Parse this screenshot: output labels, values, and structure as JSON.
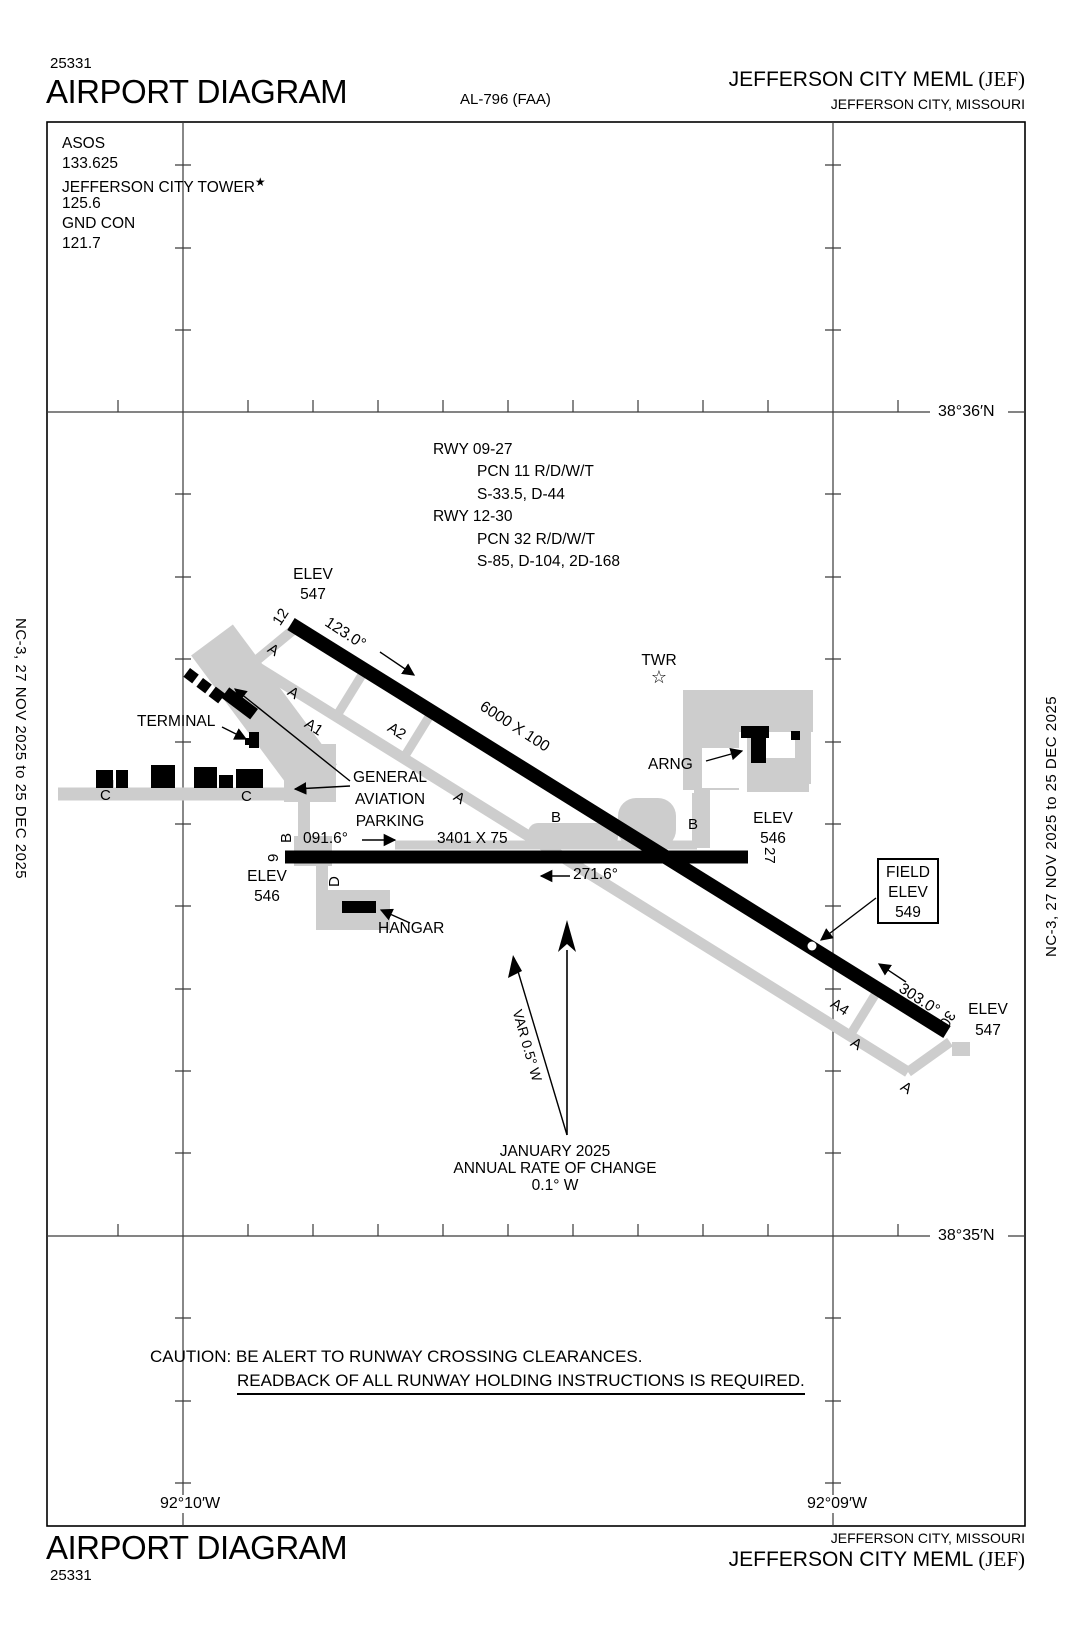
{
  "header": {
    "chart_number": "25331",
    "title": "AIRPORT DIAGRAM",
    "al_ref": "AL-796 (FAA)",
    "airport_name": "JEFFERSON CITY MEML",
    "airport_code": "(JEF)",
    "city": "JEFFERSON CITY, MISSOURI"
  },
  "comm": {
    "asos_label": "ASOS",
    "asos_freq": "133.625",
    "tower_label": "JEFFERSON CITY TOWER",
    "tower_star": "★",
    "tower_freq": "125.6",
    "gnd_label": "GND CON",
    "gnd_freq": "121.7"
  },
  "side": {
    "left": "NC-3,  27 NOV 2025  to  25 DEC 2025",
    "right": "NC-3,  27 NOV 2025  to  25 DEC 2025"
  },
  "graticule": {
    "lat_top": "38°36′N",
    "lat_bottom": "38°35′N",
    "lon_left": "92°10′W",
    "lon_right": "92°09′W"
  },
  "rwy_data": {
    "l1": "RWY 09-27",
    "l2": "PCN 11 R/D/W/T",
    "l3": "S-33.5, D-44",
    "l4": "RWY 12-30",
    "l5": "PCN 32 R/D/W/T",
    "l6": "S-85, D-104, 2D-168"
  },
  "rwy1230": {
    "end1": "12",
    "end2": "30",
    "hdg1": "123.0°",
    "hdg2": "303.0°",
    "dims": "6000 X 100",
    "elev_label": "ELEV",
    "elev1": "547",
    "elev2": "547"
  },
  "rwy0927": {
    "end1": "9",
    "end2": "27",
    "hdg1": "091.6°",
    "hdg2": "271.6°",
    "dims": "3401 X 75",
    "elev_label": "ELEV",
    "elev1": "546",
    "elev2": "546"
  },
  "labels": {
    "terminal": "TERMINAL",
    "ga1": "GENERAL",
    "ga2": "AVIATION",
    "ga3": "PARKING",
    "twr": "TWR",
    "twr_star": "☆",
    "arng": "ARNG",
    "hangar": "HANGAR",
    "field1": "FIELD",
    "field2": "ELEV",
    "field3": "549"
  },
  "taxiways": {
    "a": "A",
    "a1": "A1",
    "a2": "A2",
    "a4": "A4",
    "b": "B",
    "c": "C",
    "d": "D"
  },
  "north": {
    "jan": "JANUARY 2025",
    "rate": "ANNUAL RATE OF CHANGE",
    "val": "0.1° W",
    "var": "VAR 0.5° W"
  },
  "caution": {
    "line1": "CAUTION: BE ALERT TO RUNWAY CROSSING CLEARANCES.",
    "line2": "READBACK OF ALL RUNWAY HOLDING INSTRUCTIONS IS REQUIRED."
  },
  "footer": {
    "title": "AIRPORT DIAGRAM",
    "chart_number": "25331",
    "city": "JEFFERSON CITY, MISSOURI",
    "airport_name": "JEFFERSON CITY MEML",
    "airport_code": "(JEF)"
  },
  "colors": {
    "ink": "#000000",
    "taxiway_gray": "#cdcdcd"
  }
}
